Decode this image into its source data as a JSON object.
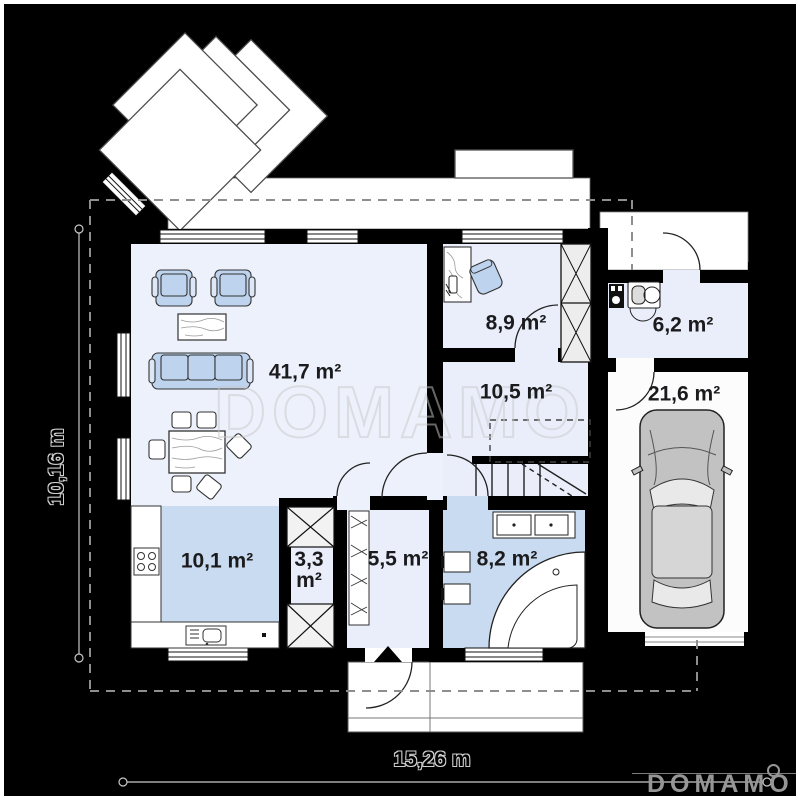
{
  "watermark": {
    "text": "DOMAMO"
  },
  "brand_logo": {
    "text": "DOMAMO"
  },
  "dimension_labels": {
    "vertical": "10,16 m",
    "horizontal": "15,26 m"
  },
  "room_labels": {
    "living": "41,7 m²",
    "office": "8,9 m²",
    "utility": "6,2 m²",
    "hall": "10,5 m²",
    "garage": "21,6 m²",
    "kitchen": "10,1 m²",
    "pantry_area": "3,3",
    "pantry_unit": "m²",
    "entry": "5,5 m²",
    "bathroom": "8,2 m²"
  },
  "colors": {
    "background": "#000000",
    "room_light": "#e9eefa",
    "living_floor": "#edf1fb",
    "wet_room_blue": "#c9dbf0",
    "furniture_blue": "#bed3ee",
    "garage_floor": "#fcfcfd",
    "label_text": "#1b1b1d",
    "watermark_outline": "#c9c9c9",
    "dash_line": "#8e8e8e"
  }
}
